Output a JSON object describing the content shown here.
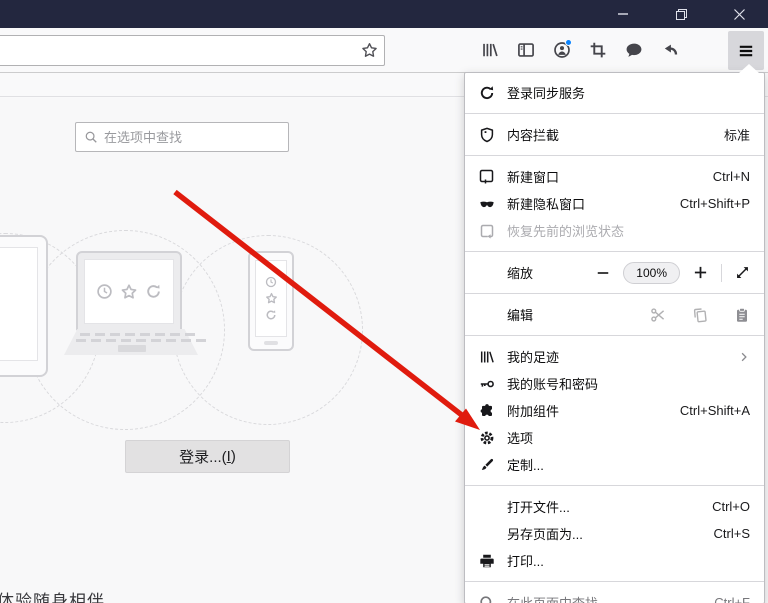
{
  "window": {
    "title": ""
  },
  "toolbar": {
    "address_value": "",
    "icons": [
      "bookmark-star",
      "library",
      "sidebar",
      "account",
      "screenshot",
      "pocket",
      "undo",
      "menu"
    ]
  },
  "colors": {
    "titlebar": "#23273f",
    "accent_blue": "#0a84ff",
    "arrow_red": "#e01b0e",
    "menu_bg": "#ffffff"
  },
  "page": {
    "search_placeholder": "在选项中查找",
    "signin_button": {
      "prefix": "登录...(",
      "accesskey": "I",
      "suffix": ")"
    },
    "footer_text": "体验随身相伴"
  },
  "menu": {
    "sync": {
      "label": "登录同步服务"
    },
    "content_blocking": {
      "label": "内容拦截",
      "value": "标准"
    },
    "new_window": {
      "label": "新建窗口",
      "shortcut": "Ctrl+N"
    },
    "new_private": {
      "label": "新建隐私窗口",
      "shortcut": "Ctrl+Shift+P"
    },
    "restore_session": {
      "label": "恢复先前的浏览状态"
    },
    "zoom": {
      "label": "缩放",
      "value": "100%"
    },
    "edit": {
      "label": "编辑"
    },
    "library": {
      "label": "我的足迹"
    },
    "logins": {
      "label": "我的账号和密码"
    },
    "addons": {
      "label": "附加组件",
      "shortcut": "Ctrl+Shift+A"
    },
    "options": {
      "label": "选项"
    },
    "customize": {
      "label": "定制..."
    },
    "open_file": {
      "label": "打开文件...",
      "shortcut": "Ctrl+O"
    },
    "save_page": {
      "label": "另存页面为...",
      "shortcut": "Ctrl+S"
    },
    "print": {
      "label": "打印..."
    },
    "find": {
      "label": "在此页面中查找...",
      "shortcut": "Ctrl+F"
    }
  }
}
